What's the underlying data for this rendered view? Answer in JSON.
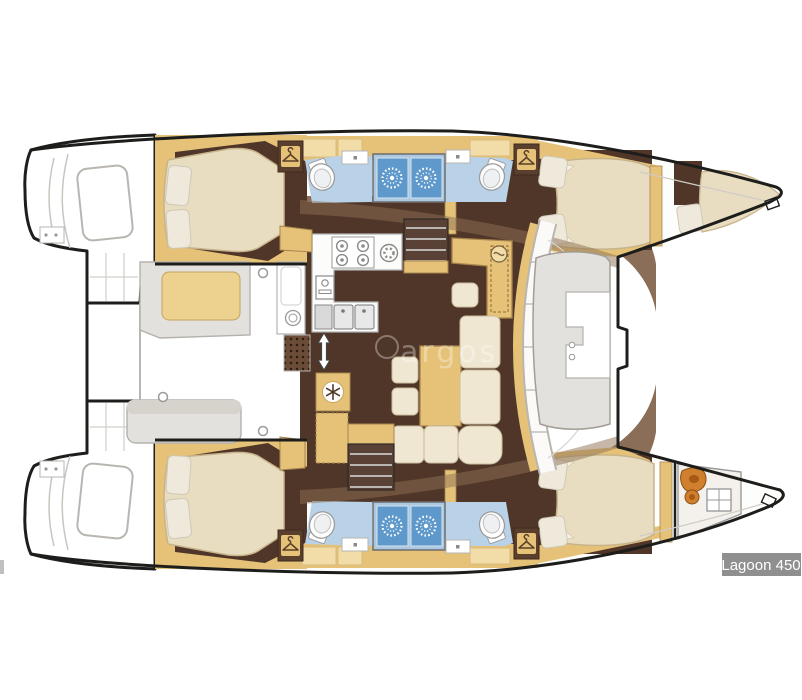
{
  "badge": {
    "label": "Lagoon 450"
  },
  "watermark": {
    "text": "argos"
  },
  "colors": {
    "outline": "#1d1d1b",
    "wood": "#e5c277",
    "wood_light": "#f2dca8",
    "wood_edge": "#a8854f",
    "floor_dark": "#503628",
    "floor_mid": "#8a6e58",
    "floor_fan": "#8d7053",
    "bed": "#e9ddc1",
    "bed_edge": "#c7b48c",
    "pillow": "#efe9db",
    "bath_floor": "#b9d2e7",
    "shower_blue": "#5f98cb",
    "shower_frame": "#abc8e0",
    "bench_gray": "#e3e1dd",
    "line_gray": "#b9b6b1",
    "orange": "#cf7f2e",
    "badge_bg": "#8f8f8f",
    "badge_text": "#ffffff"
  },
  "icons": {
    "shower": "sunburst",
    "wardrobe": "clothes-hanger",
    "fridge": "snowflake",
    "stove_burner": "ring",
    "oven": "dial",
    "washer": "concentric-rings",
    "companionway": "up-down-arrow",
    "nav_instrument": "dial-wave",
    "toilet": "oval",
    "sink": "basin-dot"
  }
}
